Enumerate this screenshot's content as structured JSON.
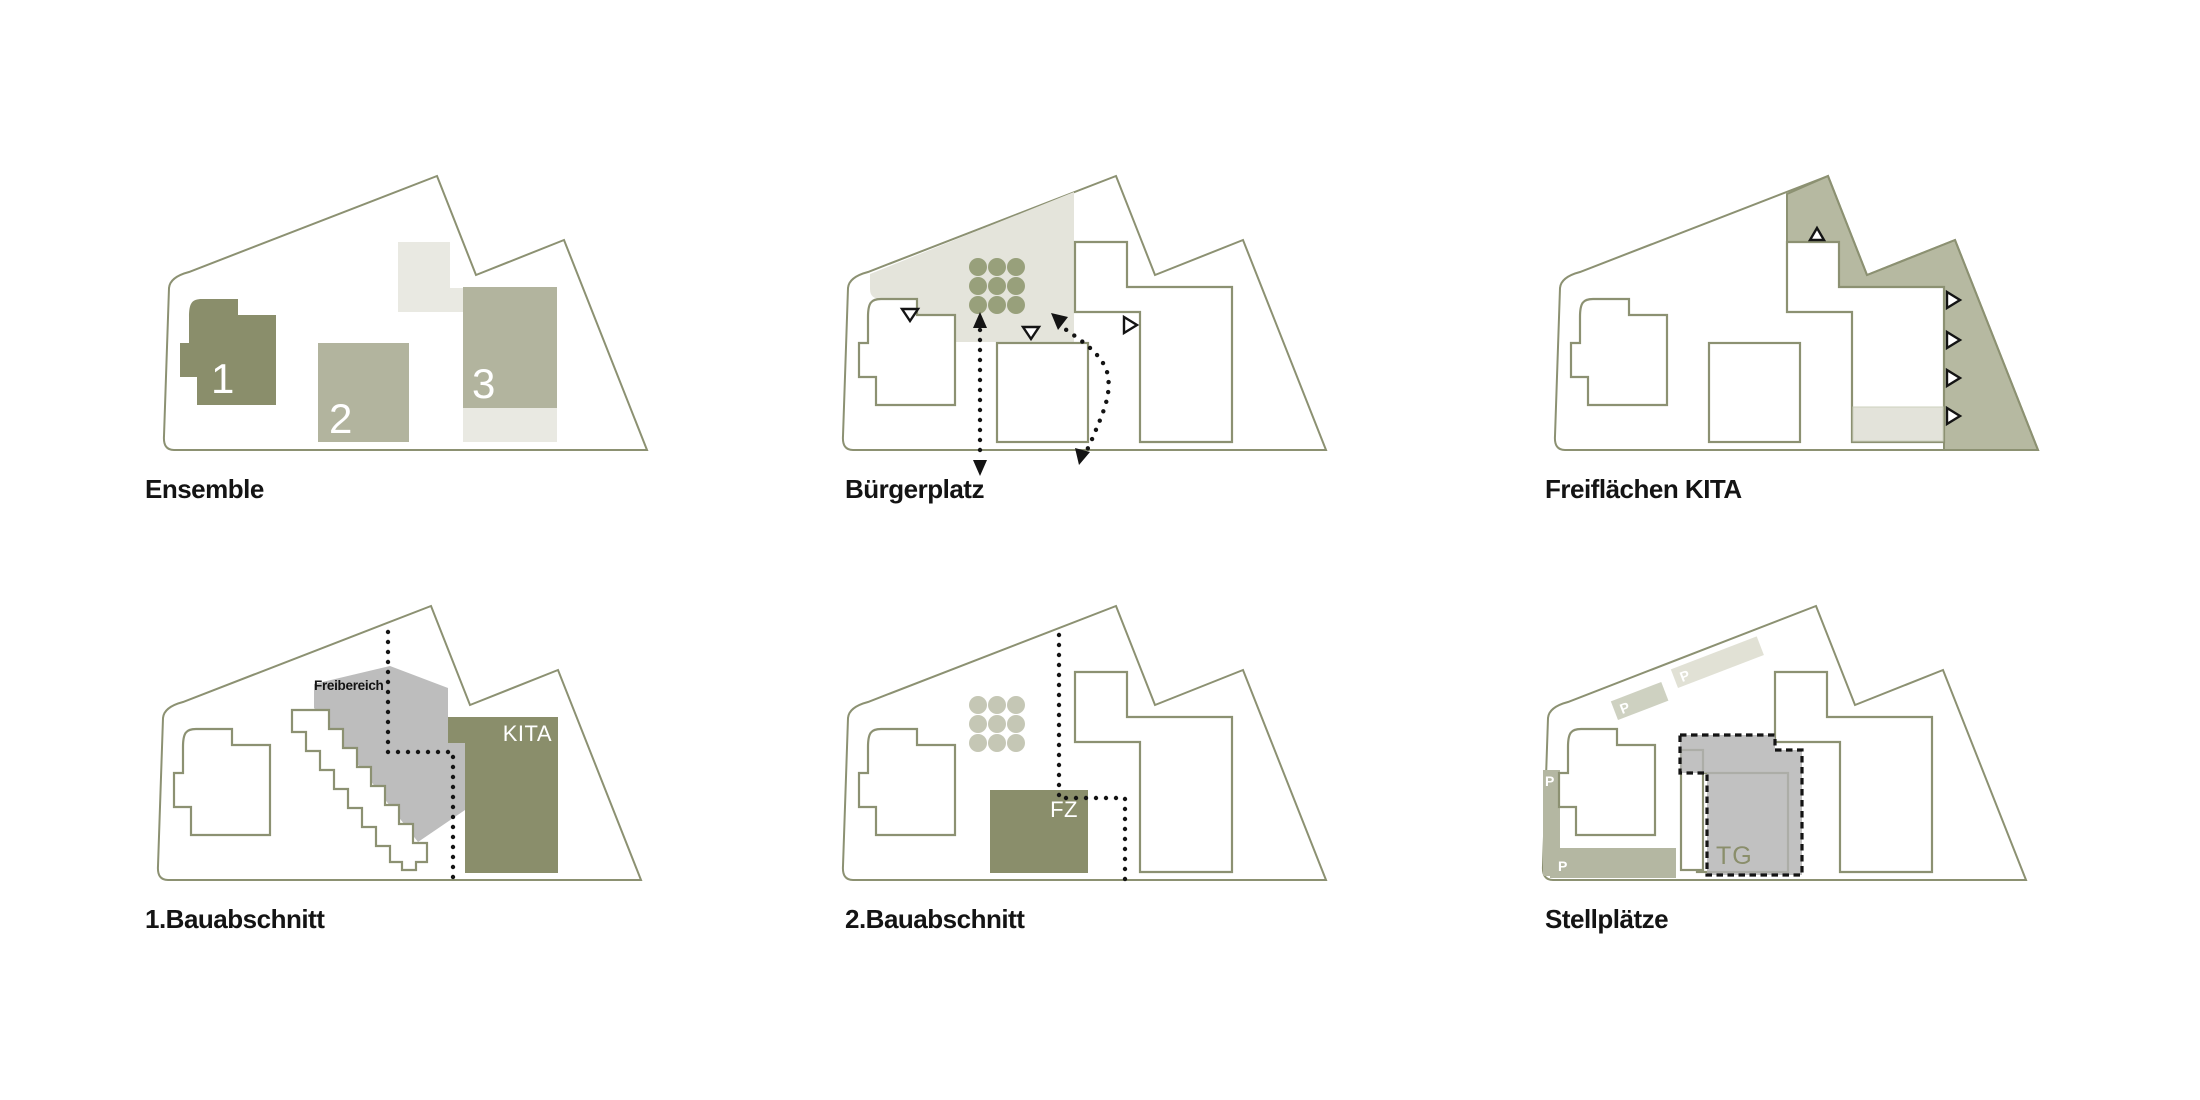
{
  "page": {
    "background": "#ffffff",
    "grid": "2 rows x 3 columns of site-plan concept diagrams"
  },
  "colors": {
    "outline_olive": "#8c9172",
    "dark_olive_fill": "#8a8e6b",
    "medium_sage_fill": "#b2b49e",
    "pale_sage_zone": "#b6b9a1",
    "plaza_light": "#e4e4db",
    "light_gray_block": "#e9e9e2",
    "tree_olive": "#98a07b",
    "tree_pale": "#c5c7b5",
    "neutral_gray": "#bdbdbd",
    "tg_gray": "#b3b3b3",
    "parking_sage": "#b4b7a2",
    "parking_light": "#d9dacb",
    "marker_black": "#141414"
  },
  "cells": [
    {
      "id": "ensemble",
      "label": "Ensemble",
      "buildings": [
        "1",
        "2",
        "3"
      ]
    },
    {
      "id": "buergerplatz",
      "label": "Bürgerplatz"
    },
    {
      "id": "freiflaechen-kita",
      "label": "Freiflächen KITA"
    },
    {
      "id": "bauabschnitt-1",
      "label": "1.Bauabschnitt",
      "area_label": "Freibereich",
      "building_label": "KITA"
    },
    {
      "id": "bauabschnitt-2",
      "label": "2.Bauabschnitt",
      "building_label": "FZ"
    },
    {
      "id": "stellplaetze",
      "label": "Stellplätze",
      "garage_label": "TG",
      "parking_label": "P"
    }
  ]
}
